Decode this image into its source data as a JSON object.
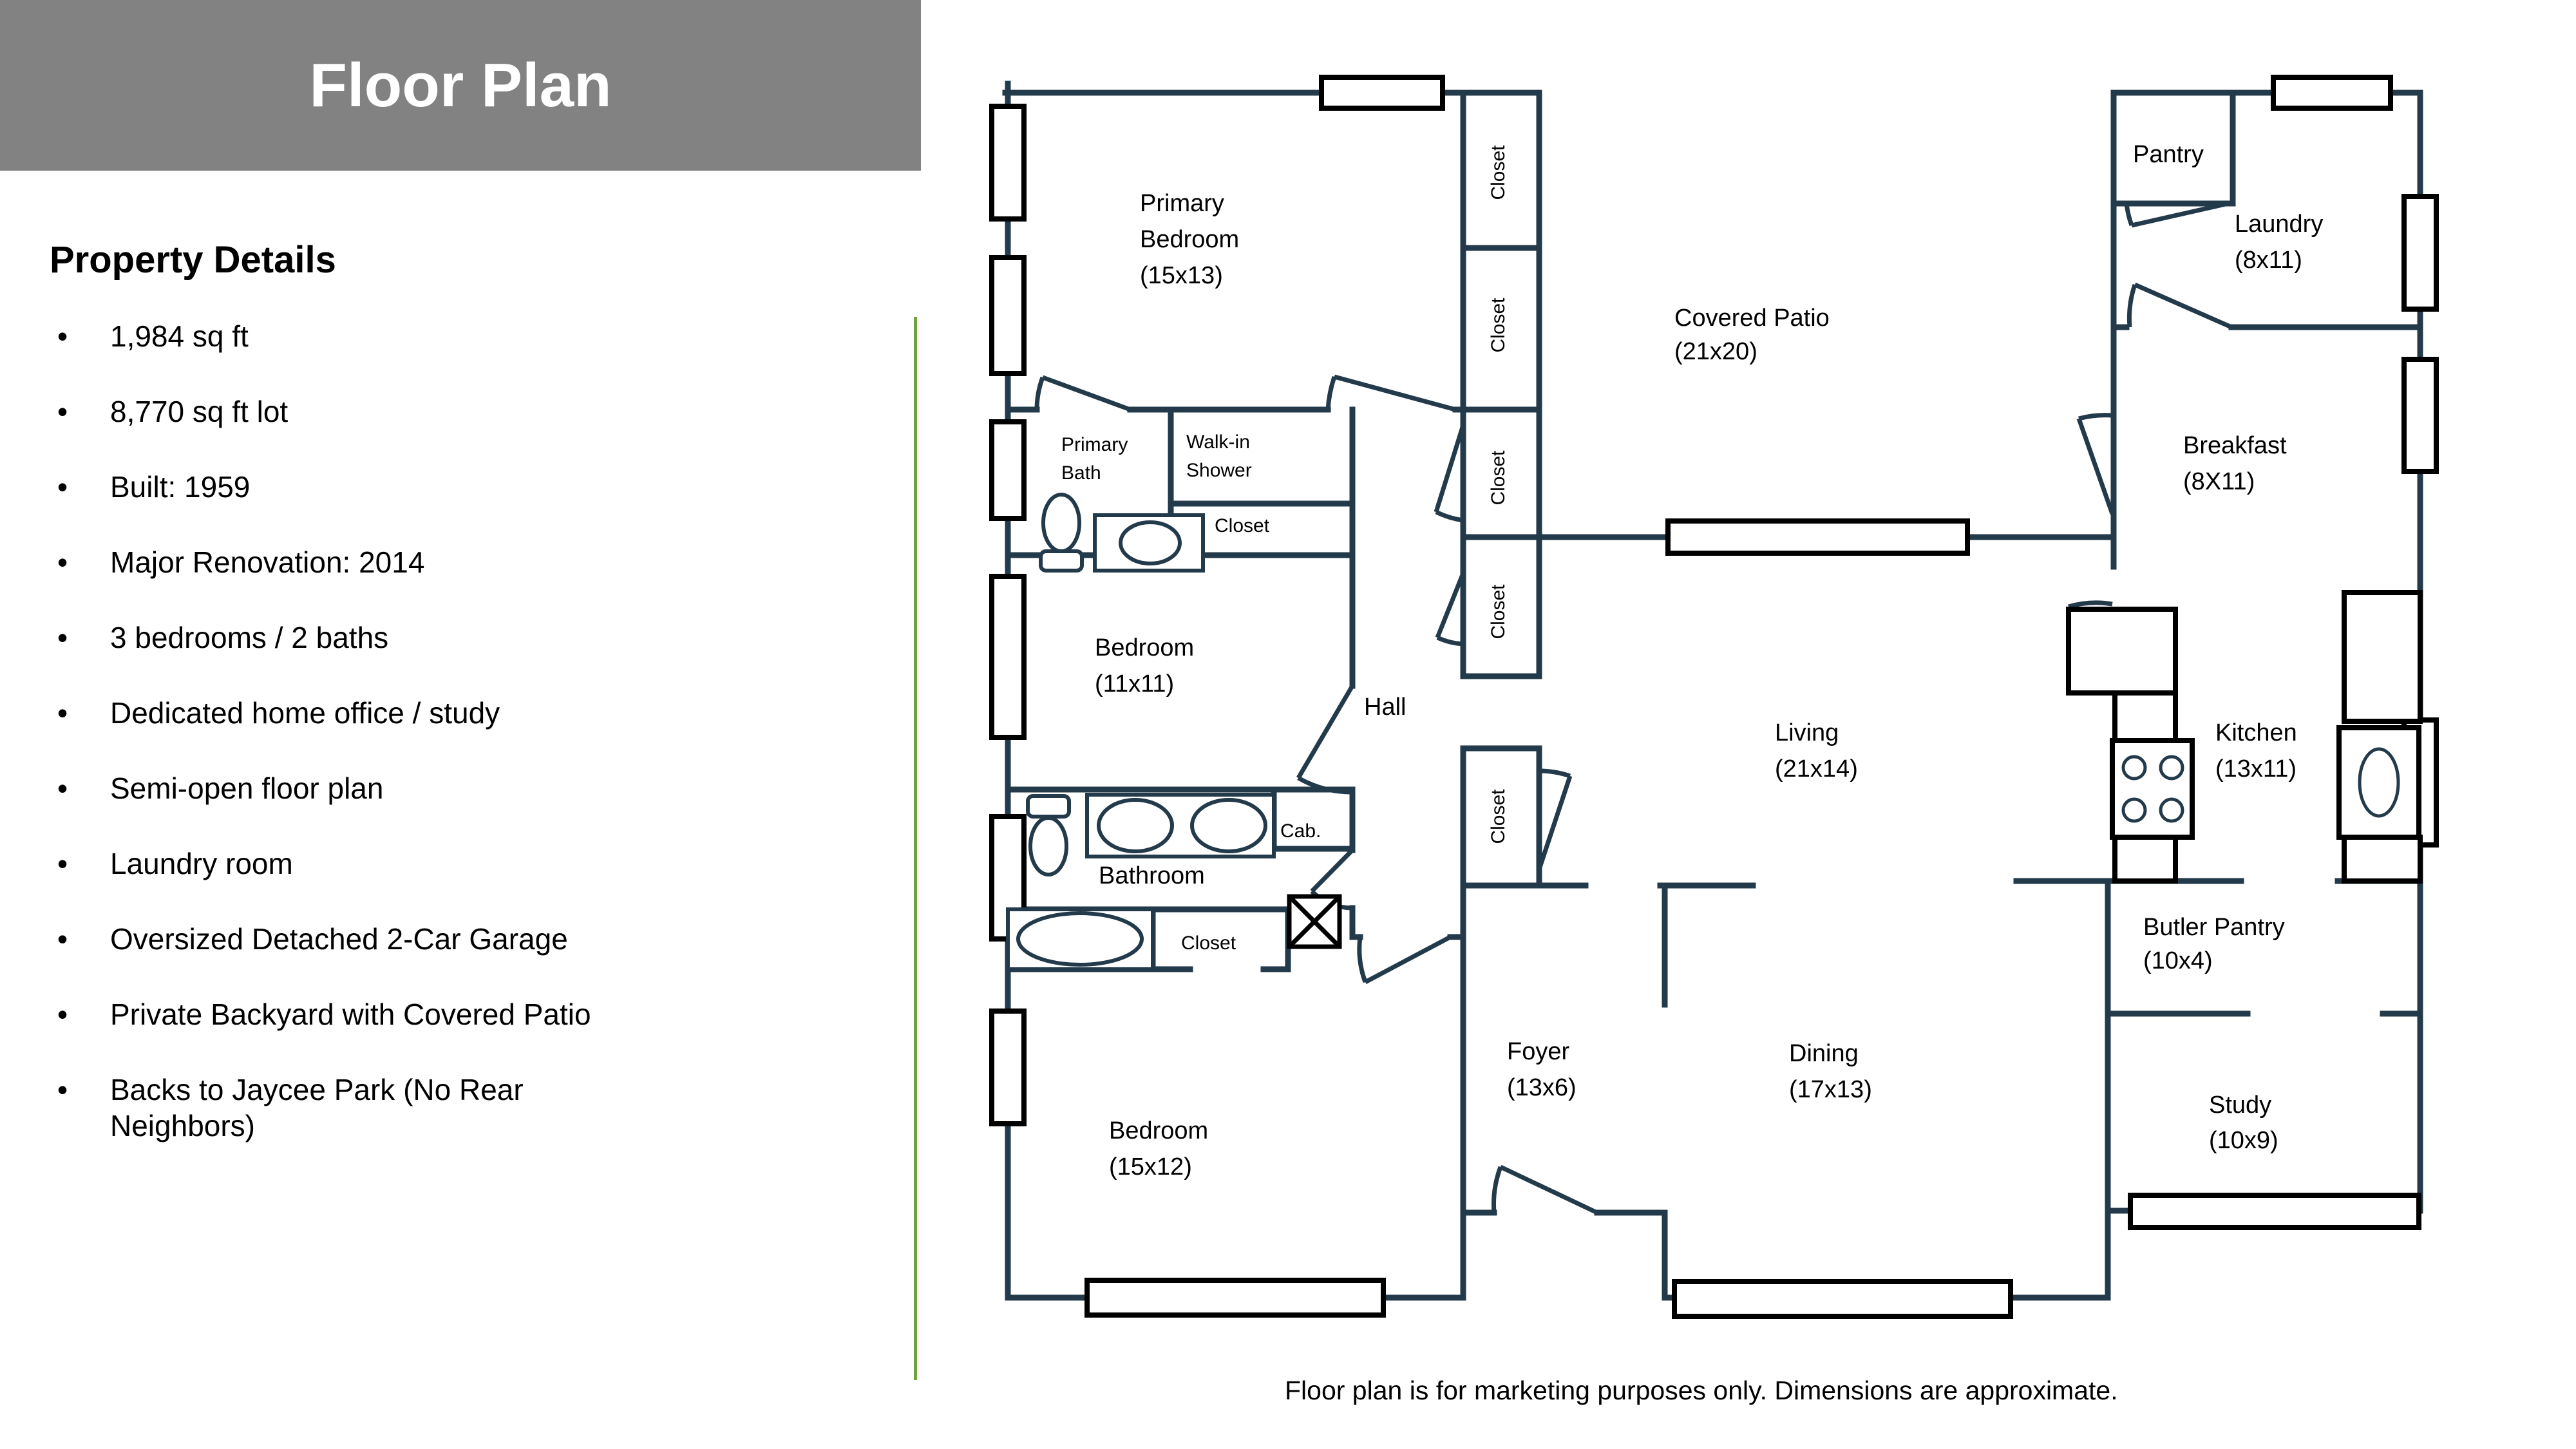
{
  "header": {
    "title": "Floor Plan"
  },
  "property": {
    "heading": "Property Details",
    "bullets": [
      "1,984 sq ft",
      "8,770 sq ft lot",
      "Built: 1959",
      "Major Renovation: 2014",
      "3 bedrooms / 2 baths",
      "Dedicated home office / study",
      "Semi-open floor plan",
      "Laundry room",
      "Oversized Detached 2-Car Garage",
      "Private Backyard with Covered Patio"
    ],
    "last_bullet_line1": "Backs to Jaycee Park (No Rear",
    "last_bullet_line2": "Neighbors)",
    "bullet_glyph": "•"
  },
  "disclaimer": "Floor plan is for marketing purposes only. Dimensions are approximate.",
  "colors": {
    "wall": "#223a4a",
    "fixture_black": "#000000",
    "header_gray": "#828282",
    "accent_green": "#6FA33C"
  },
  "floorplan": {
    "primary_bedroom": [
      "Primary",
      "Bedroom",
      "(15x13)"
    ],
    "primary_bath": [
      "Primary",
      "Bath"
    ],
    "walk_in_shower": [
      "Walk-in",
      "Shower"
    ],
    "shower_closet": "Closet",
    "bedroom2": [
      "Bedroom",
      "(11x11)"
    ],
    "bathroom": "Bathroom",
    "cab": "Cab.",
    "bath_closet": "Closet",
    "bedroom3": [
      "Bedroom",
      "(15x12)"
    ],
    "hall": "Hall",
    "foyer": [
      "Foyer",
      "(13x6)"
    ],
    "dining": [
      "Dining",
      "(17x13)"
    ],
    "living": [
      "Living",
      "(21x14)"
    ],
    "covered_patio": [
      "Covered Patio",
      "(21x20)"
    ],
    "pantry": "Pantry",
    "laundry": [
      "Laundry",
      "(8x11)"
    ],
    "breakfast": [
      "Breakfast",
      "(8X11)"
    ],
    "kitchen": [
      "Kitchen",
      "(13x11)"
    ],
    "butler_pantry": [
      "Butler Pantry",
      "(10x4)"
    ],
    "study": [
      "Study",
      "(10x9)"
    ],
    "closet_labels": [
      "Closet",
      "Closet",
      "Closet",
      "Closet",
      "Closet"
    ]
  }
}
